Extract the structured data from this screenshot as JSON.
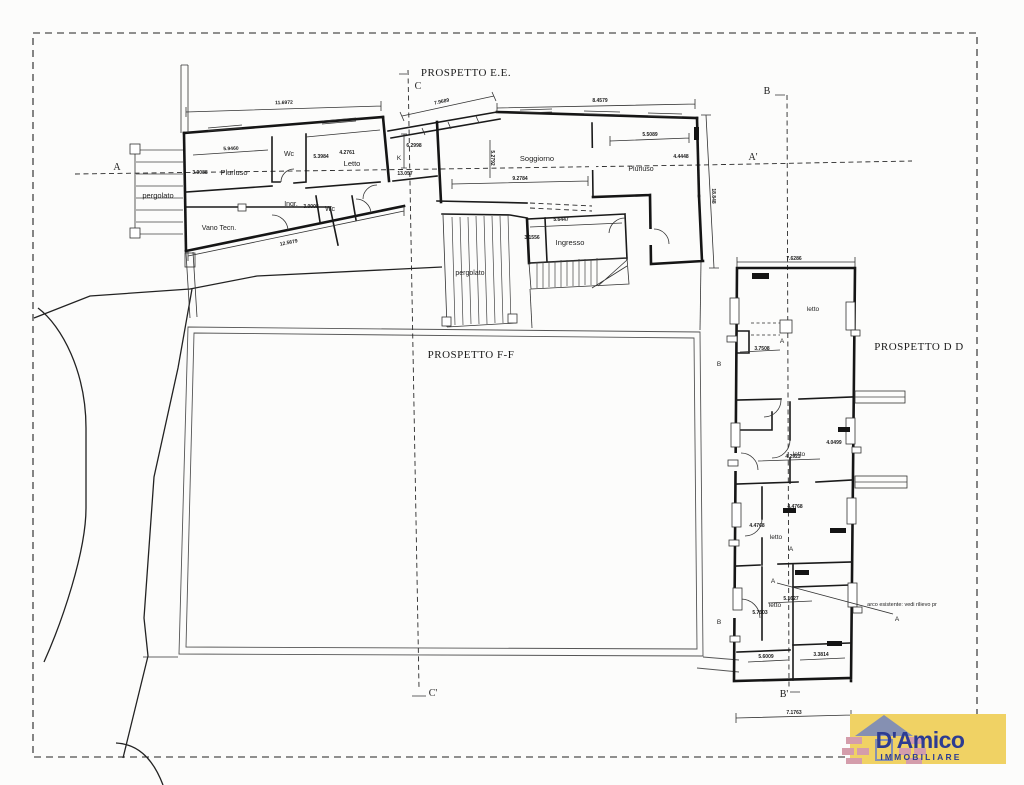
{
  "plan": {
    "prospetti": {
      "ee": "PROSPETTO E.E.",
      "ff": "PROSPETTO F-F",
      "dd": "PROSPETTO D D"
    },
    "sections": {
      "a": "A",
      "a_prime": "A'",
      "b": "B",
      "b_prime": "B'",
      "c": "C",
      "c_prime": "C'",
      "k": "K",
      "b_wing_upper": "B",
      "b_wing_lower": "B",
      "a_marker_1": "A",
      "a_marker_2": "A",
      "a_marker_3": "A",
      "a_marker_4": "A"
    },
    "rooms": {
      "pergolato_left": "pergolato",
      "plurluso_left": "Plurluso",
      "wc_top": "Wc",
      "letto_main": "Letto",
      "ingr": "Ingr.",
      "wc_bottom": "Wc",
      "vano_tecn": "Vano Tecn.",
      "soggiorno": "Soggiorno",
      "plurluso_right": "Plurluso",
      "ingresso": "Ingresso",
      "pergolato_center": "pergolato",
      "letto_1": "letto",
      "letto_2": "letto",
      "letto_3": "letto",
      "letto_4": "letto"
    },
    "annotation_arco": "arco esistente: vedi rilievo pr",
    "dimensions": {
      "main_top": "11.6972",
      "main_bottom": "12.5679",
      "band": "7.9689",
      "sog_top": "8.4579",
      "plur2_w": "5.5089",
      "plur2_h": "4.4448",
      "right_v": "18.848",
      "sog_w": "9.2784",
      "sog_h": "5.2792",
      "ingresso_w": "5.6447",
      "ingresso_h": "3.1556",
      "plur1_w": "5.9460",
      "plur1_l": "3.9088",
      "letto_a": "5.3984",
      "letto_b": "4.2761",
      "ingr_w": "3.0008",
      "k_a": "6.2998",
      "k_b": "13.057",
      "wing_top": "7.6286",
      "wing_niche": "3.7508",
      "wing_r2a": "4.0499",
      "wing_r2b": "4.2923",
      "wing_r3a": "4.4768",
      "wing_r3b": "4.4768",
      "wing_r4a": "5.7503",
      "wing_r4b": "5.1627",
      "wing_r4c": "5.6009",
      "wing_r4d": "3.3814",
      "wing_bottom": "7.1763"
    }
  },
  "logo": {
    "brand": "D'Amico",
    "tagline": "IMMOBILIARE",
    "colors": {
      "background": "#f0d264",
      "text": "#2d3c92",
      "roof": "#8590b2",
      "brick": "#d49dab"
    }
  }
}
